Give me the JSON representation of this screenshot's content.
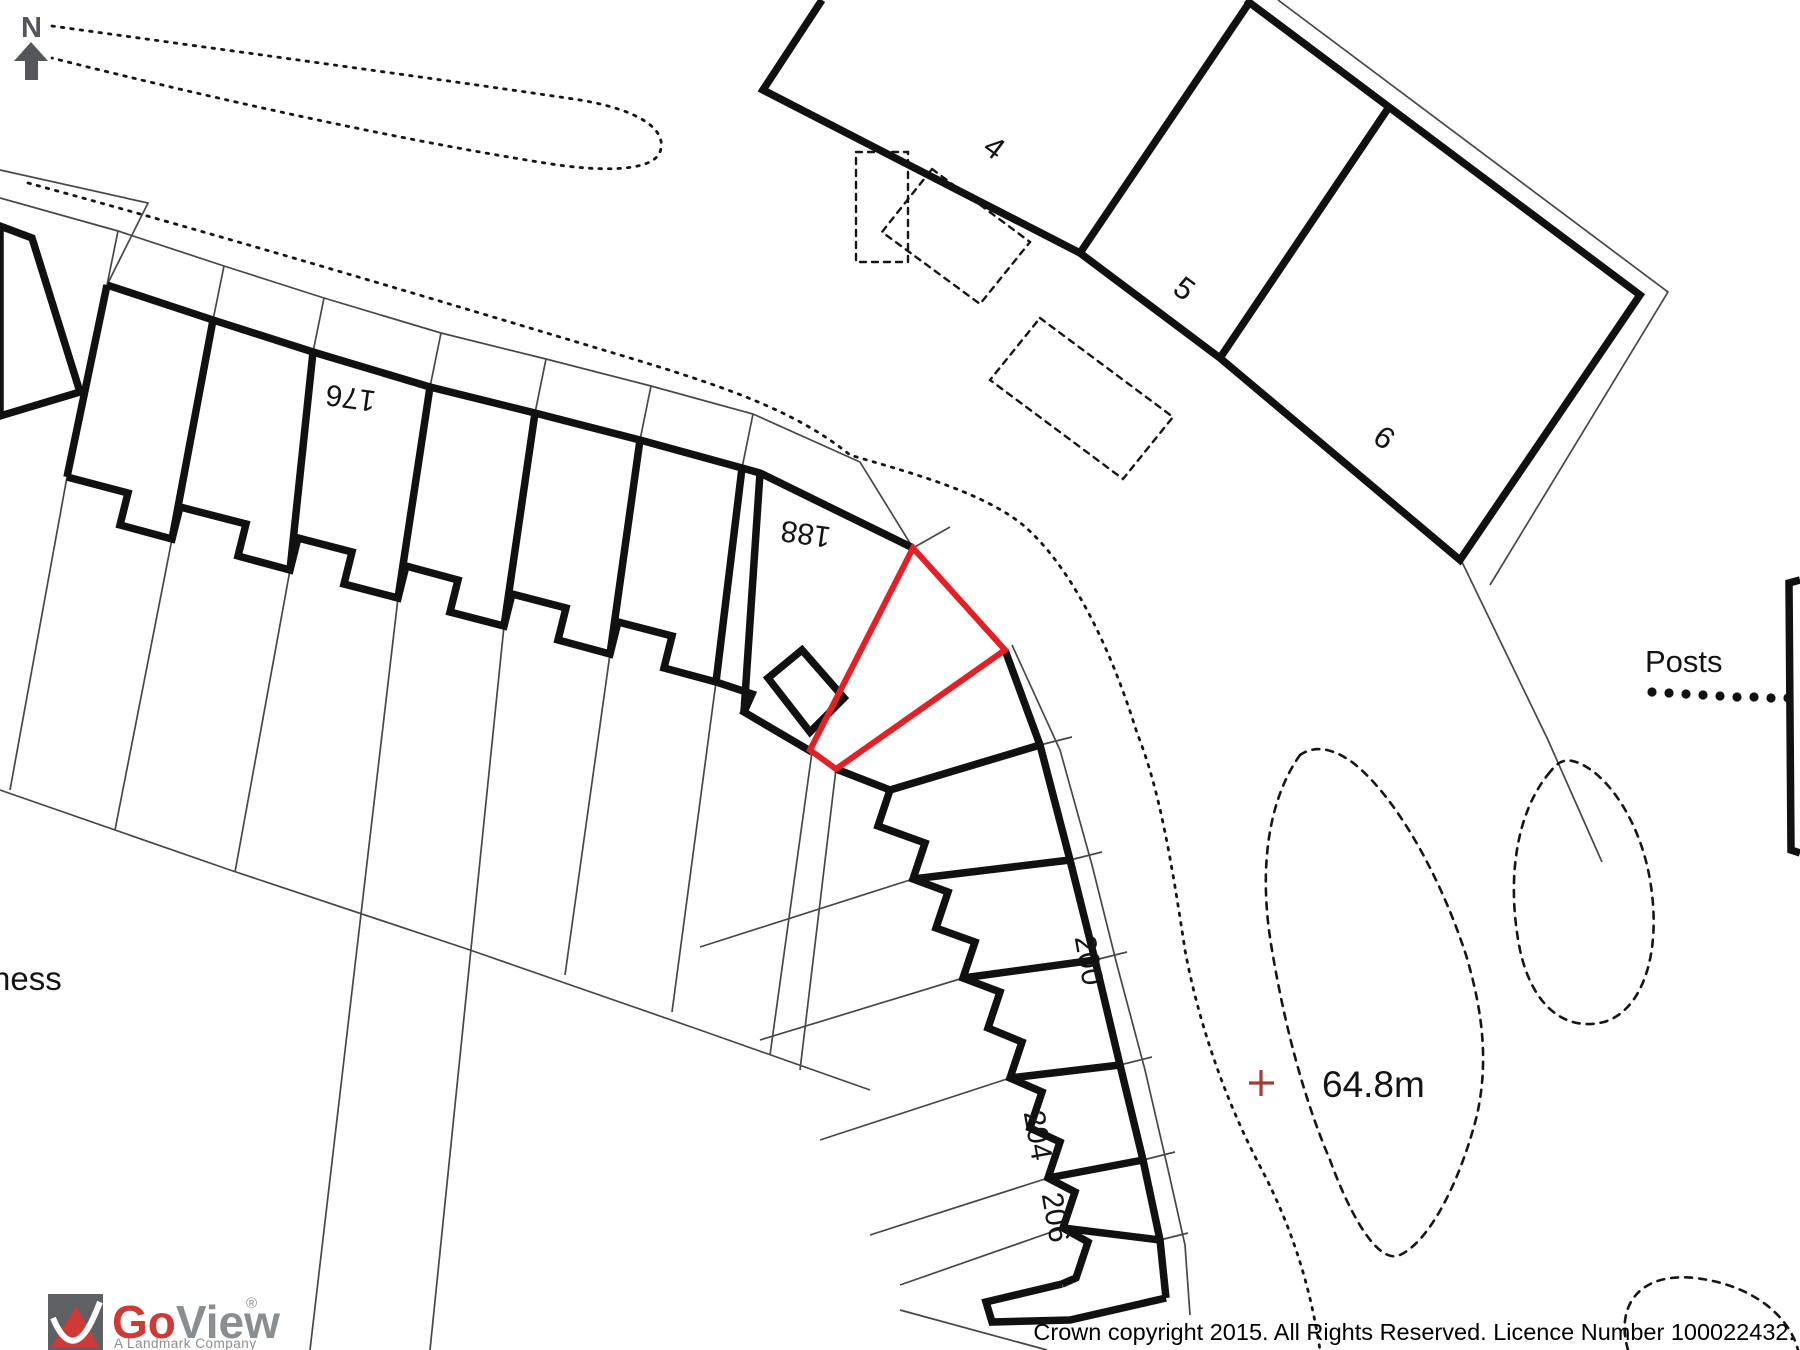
{
  "north": {
    "letter": "N"
  },
  "plan": {
    "house_numbers": {
      "n176": "176",
      "n188": "188",
      "n200": "200",
      "n204": "204",
      "n206": "206"
    },
    "plot_numbers": {
      "n4": "4",
      "n5": "5",
      "n6": "6"
    },
    "annotations": {
      "posts": "Posts",
      "spot_height": "64.8m",
      "street_fragment": "ness"
    }
  },
  "branding": {
    "go": "Go",
    "view": "View",
    "registered": "®",
    "tagline": "A Landmark Company"
  },
  "footer": {
    "copyright": "Crown copyright 2015. All Rights Reserved. Licence Number 100022432."
  },
  "colors": {
    "plot_outline_red": "#e32025",
    "spot_cross_red": "#a23c36",
    "logo_red": "#ce3a35",
    "logo_gray": "#8b8e90",
    "north_gray": "#54565a",
    "ink": "#141414"
  }
}
